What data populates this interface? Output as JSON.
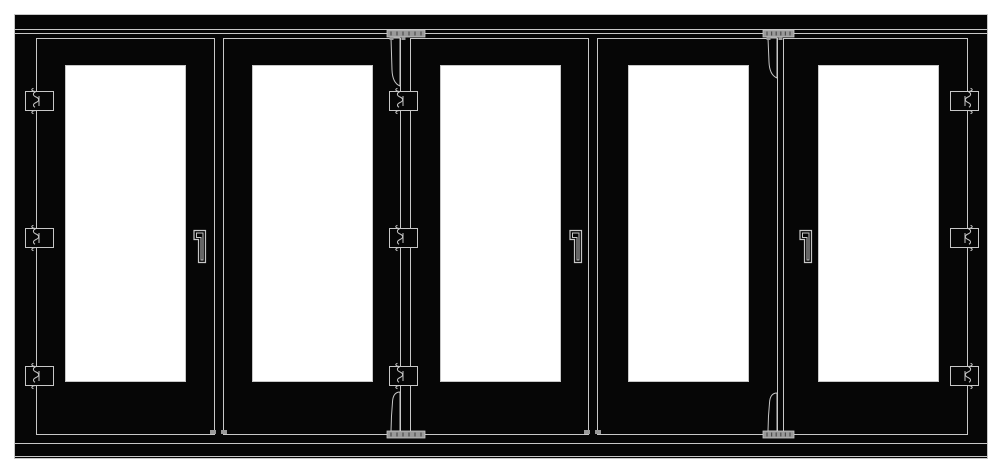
{
  "meta": {
    "description": "Technical elevation drawing of a five-panel bi-fold (folding) door system",
    "panel_count": 5,
    "hinge_count": 9,
    "handle_count": 3,
    "roller_count": 2
  },
  "colors": {
    "background": "#ffffff",
    "frame": "#060606",
    "line": "#c7c7c7",
    "glass": "#ffffff",
    "plate": "#999999",
    "hatch": "#4d4d4d"
  },
  "drawing": {
    "canvas": {
      "w": 1003,
      "h": 475
    },
    "frame": {
      "x": 14.5,
      "y": 14.5,
      "w": 973,
      "h": 444
    },
    "head_lines_y": [
      29.5,
      33.5
    ],
    "track_lines_y": [
      443.5,
      456.5
    ],
    "leaf_top": 38.5,
    "leaf_bottom": 434.5,
    "pane_top": 65.5,
    "pane_bottom": 381.5,
    "leaves": [
      {
        "id": 1,
        "x1": 36.5,
        "x2": 214.5
      },
      {
        "id": 2,
        "x1": 223.5,
        "x2": 400.5
      },
      {
        "id": 3,
        "x1": 410.5,
        "x2": 588.5
      },
      {
        "id": 4,
        "x1": 597.5,
        "x2": 777.5
      },
      {
        "id": 5,
        "x1": 783.5,
        "x2": 967.5
      }
    ],
    "panes": [
      {
        "leaf": 1,
        "x1": 65.5,
        "x2": 185.5
      },
      {
        "leaf": 2,
        "x1": 252.5,
        "x2": 372.5
      },
      {
        "leaf": 3,
        "x1": 440.5,
        "x2": 560.5
      },
      {
        "leaf": 4,
        "x1": 628.5,
        "x2": 748.5
      },
      {
        "leaf": 5,
        "x1": 818.5,
        "x2": 938.5
      }
    ],
    "hinge_rows_y": [
      89,
      226,
      364
    ],
    "hinge_columns": [
      {
        "x": 36.5,
        "knuckle": "left",
        "location": "left-jamb"
      },
      {
        "x": 400.5,
        "knuckle": "left",
        "location": "fold-joint-2-3"
      },
      {
        "x": 967.5,
        "knuckle": "right",
        "location": "right-jamb"
      }
    ],
    "rollers": [
      {
        "x": 400.5,
        "plate_x": 387,
        "plate_w": 38,
        "top_strap_end": 86,
        "bottom_strap_end": 392,
        "location": "fold-joint-2-3"
      },
      {
        "x": 777.5,
        "plate_x": 763,
        "plate_w": 31,
        "top_strap_end": 78,
        "bottom_strap_end": 393,
        "location": "fold-joint-4-5"
      }
    ],
    "top_plate_y": 30,
    "bottom_plate_y": 431,
    "plate_h": 7,
    "handles": [
      {
        "x": 193,
        "leaf": 1
      },
      {
        "x": 569,
        "leaf": 3
      },
      {
        "x": 799,
        "leaf": 5
      }
    ],
    "handle_y": 230,
    "bolt_marks_x": [
      210,
      221,
      584,
      595
    ],
    "bolt_mark_y": 430
  }
}
